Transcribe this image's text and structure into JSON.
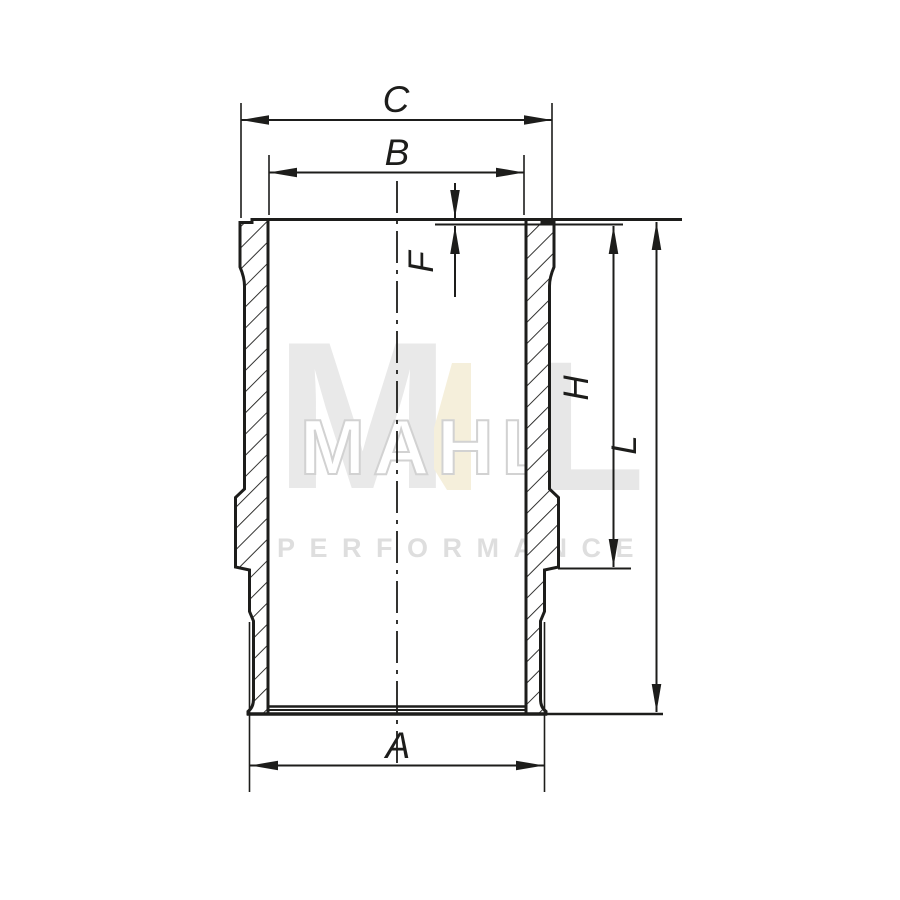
{
  "drawing": {
    "type": "technical-drawing",
    "subject": "cylinder liner cross-section",
    "background": "#ffffff",
    "line_color": "#1d1d1b",
    "dimensions": {
      "c": "C",
      "b": "B",
      "f": "F",
      "h": "H",
      "l": "L",
      "a": "A"
    }
  },
  "watermark": {
    "letter_m": "M",
    "outline_letters": "MAHL",
    "letter_l": "L",
    "tagline": "PERFORMANCE",
    "gray": "#e9e9e9",
    "outline_gray": "#d2d2d2",
    "beige": "#f5efdb",
    "tagline_gray": "#dedede"
  }
}
